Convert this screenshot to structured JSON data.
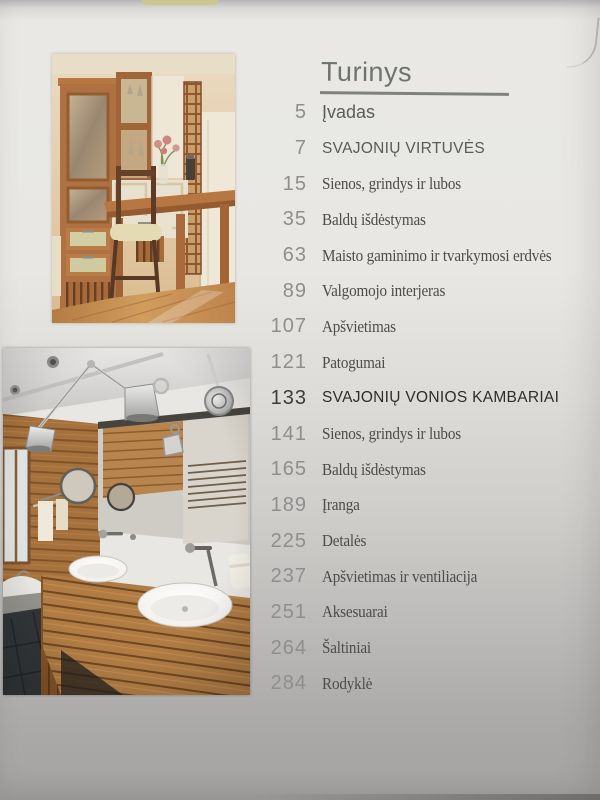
{
  "toc": {
    "title": "Turinys",
    "entries": [
      {
        "number": "5",
        "title": "Įvadas",
        "style": "sans"
      },
      {
        "number": "7",
        "title": "SVAJONIŲ VIRTUVĖS",
        "style": "chapter"
      },
      {
        "number": "15",
        "title": "Sienos, grindys ir lubos",
        "style": "serif"
      },
      {
        "number": "35",
        "title": "Baldų išdėstymas",
        "style": "serif"
      },
      {
        "number": "63",
        "title": "Maisto gaminimo ir tvarkymosi erdvės",
        "style": "serif"
      },
      {
        "number": "89",
        "title": "Valgomojo interjeras",
        "style": "serif"
      },
      {
        "number": "107",
        "title": "Apšvietimas",
        "style": "serif"
      },
      {
        "number": "121",
        "title": "Patogumai",
        "style": "serif"
      },
      {
        "number": "133",
        "title": "SVAJONIŲ VONIOS KAMBARIAI",
        "style": "chapter-dark"
      },
      {
        "number": "141",
        "title": "Sienos, grindys ir lubos",
        "style": "serif"
      },
      {
        "number": "165",
        "title": "Baldų išdėstymas",
        "style": "serif"
      },
      {
        "number": "189",
        "title": "Įranga",
        "style": "serif"
      },
      {
        "number": "225",
        "title": "Detalės",
        "style": "serif"
      },
      {
        "number": "237",
        "title": "Apšvietimas ir ventiliacija",
        "style": "serif"
      },
      {
        "number": "251",
        "title": "Aksesuarai",
        "style": "serif"
      },
      {
        "number": "264",
        "title": "Šaltiniai",
        "style": "serif"
      },
      {
        "number": "284",
        "title": "Rodyklė",
        "style": "serif"
      }
    ]
  },
  "photos": {
    "kitchen": {
      "alt": "photo of kitchen with tall wooden glass-door cabinet, white cupboards, wine rack, wooden desk table with chair and flowers"
    },
    "bathroom": {
      "alt": "photo of bathroom with wood plank wall, large mirror, chrome swing-arm lamps, wooden vanity with two white vessel sinks"
    }
  },
  "palette": {
    "paper_light": "#e9e8e4",
    "paper_dark": "#a3a2a0",
    "number_gray": "#8e8e8e",
    "entry_serif": "#4c4c4c",
    "chapter_dark": "#2d2d2d",
    "title_gray": "#6f736f"
  }
}
